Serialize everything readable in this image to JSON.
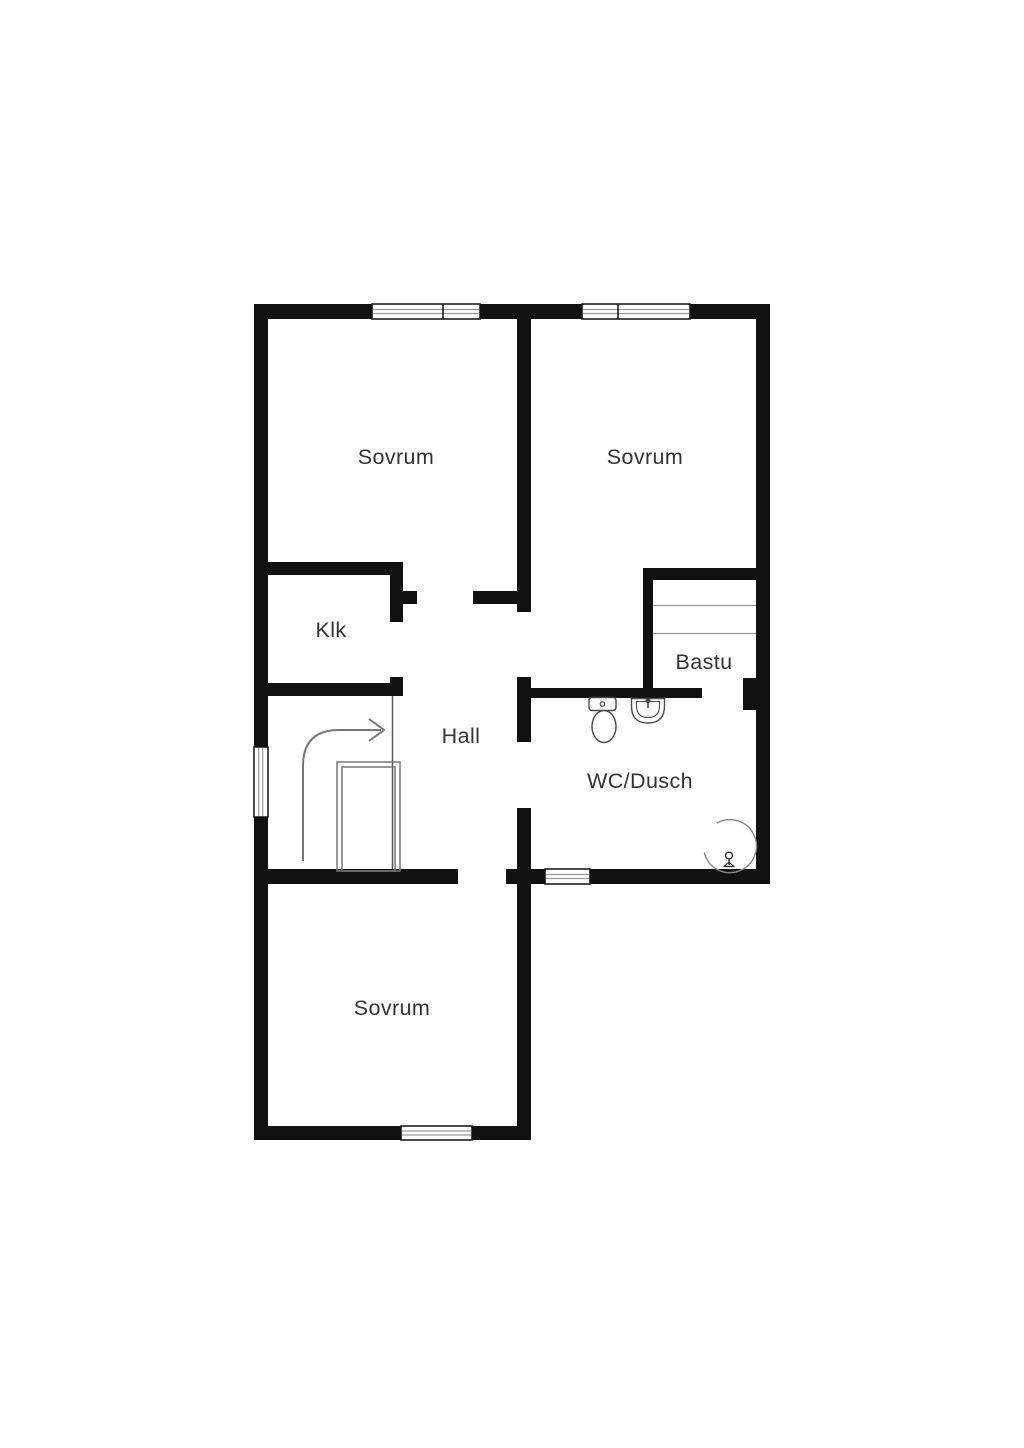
{
  "plan": {
    "type": "floor-plan",
    "floor_description": "Upper floor with three bedrooms, hall with staircase, closet, sauna and bathroom",
    "rooms": [
      {
        "key": "bedroom-top-left",
        "label": "Sovrum"
      },
      {
        "key": "bedroom-top-right",
        "label": "Sovrum"
      },
      {
        "key": "closet",
        "label": "Klk"
      },
      {
        "key": "hall",
        "label": "Hall"
      },
      {
        "key": "sauna",
        "label": "Bastu"
      },
      {
        "key": "bathroom",
        "label": "WC/Dusch"
      },
      {
        "key": "bedroom-bottom",
        "label": "Sovrum"
      }
    ],
    "fixtures": [
      "toilet",
      "washbasin",
      "corner-shower",
      "shower-mixer-symbol",
      "sauna-benches",
      "staircase-opening",
      "stairs-direction-arrow"
    ],
    "window_count": 5,
    "colors": {
      "background": "#ffffff",
      "wall": "#111111",
      "text": "#333333",
      "fixture_line": "#4a4a4a",
      "stair_line": "#777777",
      "pane_line": "#9a9a9a",
      "bench_line": "#999999",
      "shower_line": "#888888"
    }
  }
}
